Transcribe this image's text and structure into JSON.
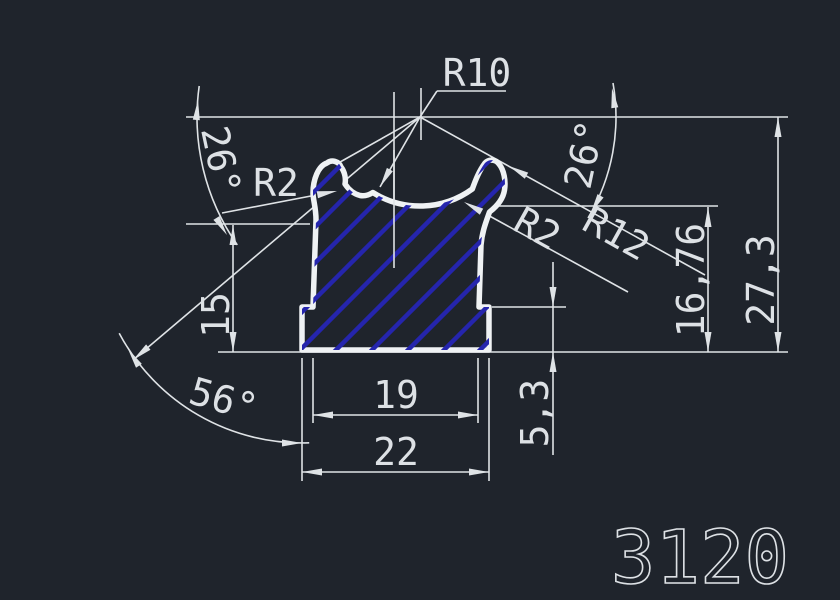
{
  "drawing": {
    "part_number": "3120",
    "labels": {
      "r10": "R10",
      "r2_left": "R2",
      "r2_right": "R2",
      "r12": "R12",
      "angle_left": "26°",
      "angle_right": "26°",
      "angle_bottom": "56°",
      "len_15": "15",
      "len_19": "19",
      "len_22": "22",
      "len_5_3": "5,3",
      "len_16_76": "16,76",
      "len_27_3": "27,3"
    },
    "colors": {
      "background": "#1f242c",
      "dimension_lines": "#dfe3e6",
      "profile_outline": "#eff2f4",
      "hatch": "#2525ad",
      "text": "#dde1e5"
    }
  }
}
